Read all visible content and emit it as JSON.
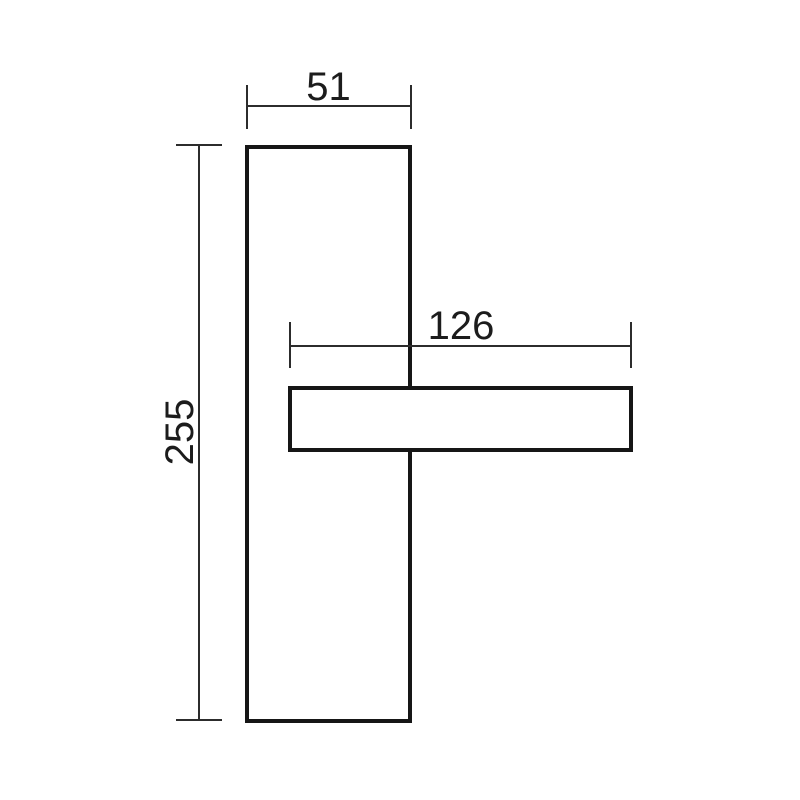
{
  "colors": {
    "background": "#ffffff",
    "outline": "#161616",
    "dimension": "#2c2c2c",
    "text": "#1c1c1c"
  },
  "drawing": {
    "labels": {
      "plate_width": "51",
      "plate_height": "255",
      "handle_length": "126"
    }
  }
}
